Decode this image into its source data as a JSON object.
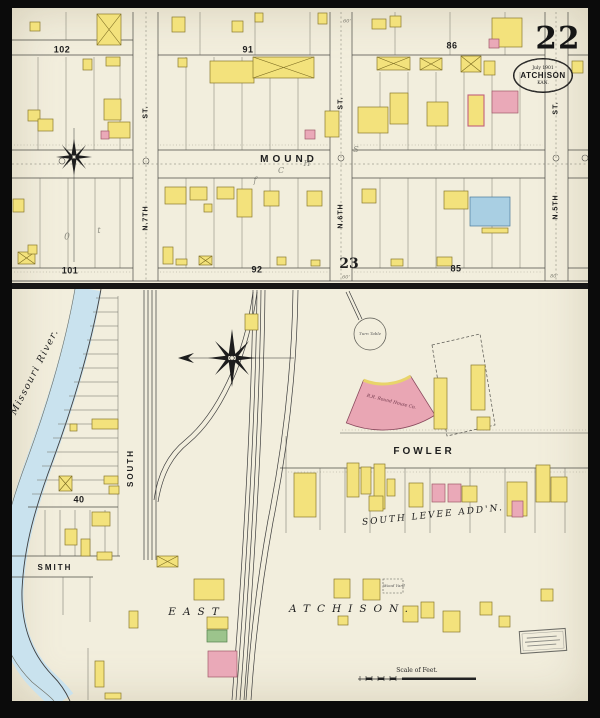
{
  "sheet": {
    "number": "22",
    "stamp_line1": "July 1901",
    "stamp_line2": "ATCHISON",
    "stamp_line3": "KAN.",
    "scale_label": "Scale of Feet."
  },
  "streets": {
    "mound": "MOUND",
    "n7th": "N.7TH",
    "n6th": "N.6TH",
    "n5th": "N.5TH",
    "st": "ST.",
    "south": "SOUTH",
    "smith": "SMITH",
    "fowler": "FOWLER",
    "south_levee": "SOUTH LEVEE ADD'N.",
    "east": "EAST",
    "atchison": "ATCHISON.",
    "river": "Missouri River."
  },
  "blocks": {
    "b102": "102",
    "b91": "91",
    "b86": "86",
    "b101": "101",
    "b92": "92",
    "b85": "85",
    "b23": "23",
    "b40": "40"
  },
  "labels": {
    "turn_table": "Turn Table",
    "round_house": "R.R. Round House Co.",
    "wood_yard": "Wood Yard"
  },
  "measurements": {
    "top": "60'",
    "bottom": "60'",
    "right": "80'"
  },
  "pencil": {
    "c": "C",
    "h": "H",
    "s": "S",
    "f": "f",
    "zero": "0",
    "t": "t"
  },
  "colors": {
    "paper": "#f2eedd",
    "building_yellow": "#f3e27c",
    "building_pink": "#eaa9b8",
    "building_blue": "#a9cfe3",
    "building_green": "#9cc48c",
    "river": "#c9e2ee"
  },
  "buildings": [
    [
      30,
      22,
      10,
      9,
      "y"
    ],
    [
      97,
      14,
      24,
      31,
      "x"
    ],
    [
      172,
      17,
      13,
      15,
      "y"
    ],
    [
      232,
      21,
      11,
      11,
      "y"
    ],
    [
      255,
      13,
      8,
      9,
      "y"
    ],
    [
      318,
      13,
      9,
      11,
      "y"
    ],
    [
      372,
      19,
      14,
      10,
      "y"
    ],
    [
      390,
      16,
      11,
      11,
      "y"
    ],
    [
      492,
      18,
      30,
      29,
      "y"
    ],
    [
      489,
      39,
      10,
      9,
      "p"
    ],
    [
      572,
      61,
      11,
      12,
      "y"
    ],
    [
      83,
      59,
      9,
      11,
      "y"
    ],
    [
      106,
      57,
      14,
      9,
      "y"
    ],
    [
      28,
      110,
      12,
      11,
      "y"
    ],
    [
      38,
      119,
      15,
      12,
      "y"
    ],
    [
      104,
      99,
      17,
      21,
      "y"
    ],
    [
      108,
      122,
      22,
      16,
      "y"
    ],
    [
      101,
      131,
      8,
      8,
      "p"
    ],
    [
      178,
      58,
      9,
      9,
      "y"
    ],
    [
      210,
      61,
      44,
      22,
      "y"
    ],
    [
      253,
      57,
      61,
      21,
      "x"
    ],
    [
      325,
      111,
      14,
      26,
      "y"
    ],
    [
      305,
      130,
      10,
      9,
      "p"
    ],
    [
      377,
      57,
      33,
      13,
      "x"
    ],
    [
      420,
      58,
      22,
      12,
      "x"
    ],
    [
      461,
      56,
      20,
      16,
      "x"
    ],
    [
      484,
      61,
      11,
      14,
      "y"
    ],
    [
      390,
      93,
      18,
      31,
      "y"
    ],
    [
      427,
      102,
      21,
      24,
      "y"
    ],
    [
      358,
      107,
      30,
      26,
      "y"
    ],
    [
      468,
      95,
      16,
      31,
      "yp"
    ],
    [
      492,
      91,
      26,
      22,
      "p"
    ],
    [
      165,
      187,
      21,
      17,
      "y"
    ],
    [
      190,
      187,
      17,
      13,
      "y"
    ],
    [
      204,
      204,
      8,
      8,
      "y"
    ],
    [
      217,
      187,
      17,
      12,
      "y"
    ],
    [
      237,
      189,
      15,
      28,
      "y"
    ],
    [
      264,
      191,
      15,
      15,
      "y"
    ],
    [
      307,
      191,
      15,
      15,
      "y"
    ],
    [
      362,
      189,
      14,
      14,
      "y"
    ],
    [
      444,
      191,
      24,
      18,
      "y"
    ],
    [
      470,
      197,
      40,
      29,
      "b"
    ],
    [
      482,
      228,
      26,
      5,
      "y"
    ],
    [
      13,
      199,
      11,
      13,
      "y"
    ],
    [
      18,
      252,
      17,
      12,
      "x"
    ],
    [
      28,
      245,
      9,
      9,
      "y"
    ],
    [
      163,
      247,
      10,
      17,
      "y"
    ],
    [
      176,
      259,
      11,
      6,
      "y"
    ],
    [
      199,
      256,
      13,
      9,
      "x"
    ],
    [
      277,
      257,
      9,
      8,
      "y"
    ],
    [
      311,
      260,
      9,
      6,
      "y"
    ],
    [
      391,
      259,
      12,
      7,
      "y"
    ],
    [
      437,
      257,
      15,
      9,
      "y"
    ],
    [
      245,
      314,
      13,
      16,
      "y"
    ],
    [
      92,
      419,
      26,
      10,
      "y"
    ],
    [
      70,
      424,
      7,
      7,
      "y"
    ],
    [
      59,
      476,
      13,
      15,
      "x"
    ],
    [
      104,
      476,
      14,
      8,
      "y"
    ],
    [
      109,
      486,
      10,
      8,
      "y"
    ],
    [
      92,
      512,
      18,
      14,
      "y"
    ],
    [
      65,
      529,
      12,
      16,
      "y"
    ],
    [
      81,
      539,
      9,
      17,
      "y"
    ],
    [
      97,
      552,
      15,
      8,
      "y"
    ],
    [
      95,
      661,
      9,
      26,
      "y"
    ],
    [
      105,
      693,
      16,
      6,
      "y"
    ],
    [
      157,
      556,
      21,
      11,
      "x"
    ],
    [
      434,
      378,
      13,
      51,
      "y"
    ],
    [
      471,
      365,
      14,
      45,
      "y"
    ],
    [
      477,
      417,
      13,
      13,
      "y"
    ],
    [
      294,
      473,
      22,
      44,
      "y"
    ],
    [
      347,
      463,
      12,
      34,
      "y"
    ],
    [
      361,
      467,
      10,
      27,
      "y"
    ],
    [
      374,
      464,
      11,
      45,
      "y"
    ],
    [
      387,
      479,
      8,
      17,
      "y"
    ],
    [
      369,
      496,
      14,
      15,
      "y"
    ],
    [
      409,
      483,
      14,
      24,
      "y"
    ],
    [
      432,
      484,
      13,
      18,
      "p"
    ],
    [
      448,
      484,
      13,
      18,
      "p"
    ],
    [
      462,
      486,
      15,
      16,
      "y"
    ],
    [
      507,
      482,
      20,
      34,
      "y"
    ],
    [
      512,
      501,
      11,
      16,
      "p"
    ],
    [
      536,
      465,
      14,
      37,
      "y"
    ],
    [
      551,
      477,
      16,
      25,
      "y"
    ],
    [
      334,
      579,
      16,
      19,
      "y"
    ],
    [
      363,
      579,
      17,
      21,
      "y"
    ],
    [
      403,
      606,
      15,
      16,
      "y"
    ],
    [
      421,
      602,
      13,
      16,
      "y"
    ],
    [
      443,
      611,
      17,
      21,
      "y"
    ],
    [
      338,
      616,
      10,
      9,
      "y"
    ],
    [
      480,
      602,
      12,
      13,
      "y"
    ],
    [
      499,
      616,
      11,
      11,
      "y"
    ],
    [
      541,
      589,
      12,
      12,
      "y"
    ],
    [
      129,
      611,
      9,
      17,
      "y"
    ],
    [
      194,
      579,
      30,
      21,
      "y"
    ],
    [
      207,
      617,
      21,
      12,
      "y"
    ],
    [
      207,
      630,
      20,
      12,
      "g"
    ],
    [
      208,
      651,
      29,
      26,
      "p"
    ]
  ]
}
